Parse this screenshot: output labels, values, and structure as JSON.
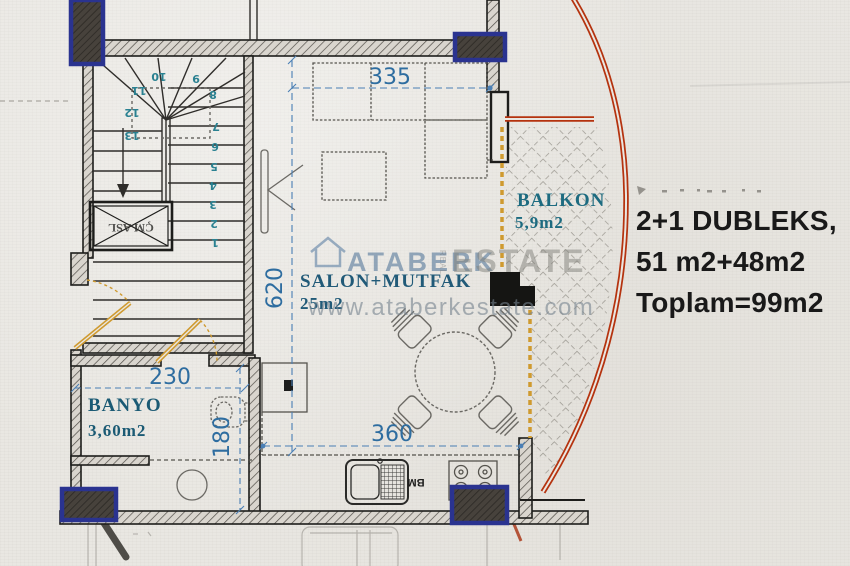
{
  "info_panel": {
    "line1": "2+1 DUBLEKS,",
    "line2": "51 m2+48m2",
    "line3": "Toplam=99m2"
  },
  "rooms": {
    "salon": {
      "name": "SALON+MUTFAK",
      "area": "25m2"
    },
    "balcony": {
      "name": "BALKON",
      "area": "5,9m2"
    },
    "bathroom": {
      "name": "BANYO",
      "area": "3,60m2"
    }
  },
  "dimensions": {
    "salon_width": "335",
    "salon_height": "620",
    "bathroom_width": "230",
    "bathroom_height": "180",
    "kitchen_width": "360"
  },
  "stairs": {
    "numbers": [
      "1",
      "2",
      "3",
      "4",
      "5",
      "6",
      "7",
      "8",
      "9",
      "10",
      "11",
      "12",
      "13"
    ],
    "shaft_label": "ÇM ASL"
  },
  "kitchen": {
    "sink_label": "BM"
  },
  "watermark": {
    "brand": "ATABERK",
    "brand_secondary": "ESTATE",
    "real_label": "REAL",
    "url": "www.ataberkestate.com"
  },
  "colors": {
    "wall": "#1d1d1b",
    "column_navy": "#2a3390",
    "dimension_blue": "#2e6da0",
    "label_teal": "#1d6b80",
    "label_blue": "#215a78",
    "balcony_red": "#b5330f",
    "door_orange": "#cf9a2f",
    "info_text": "#191919"
  }
}
